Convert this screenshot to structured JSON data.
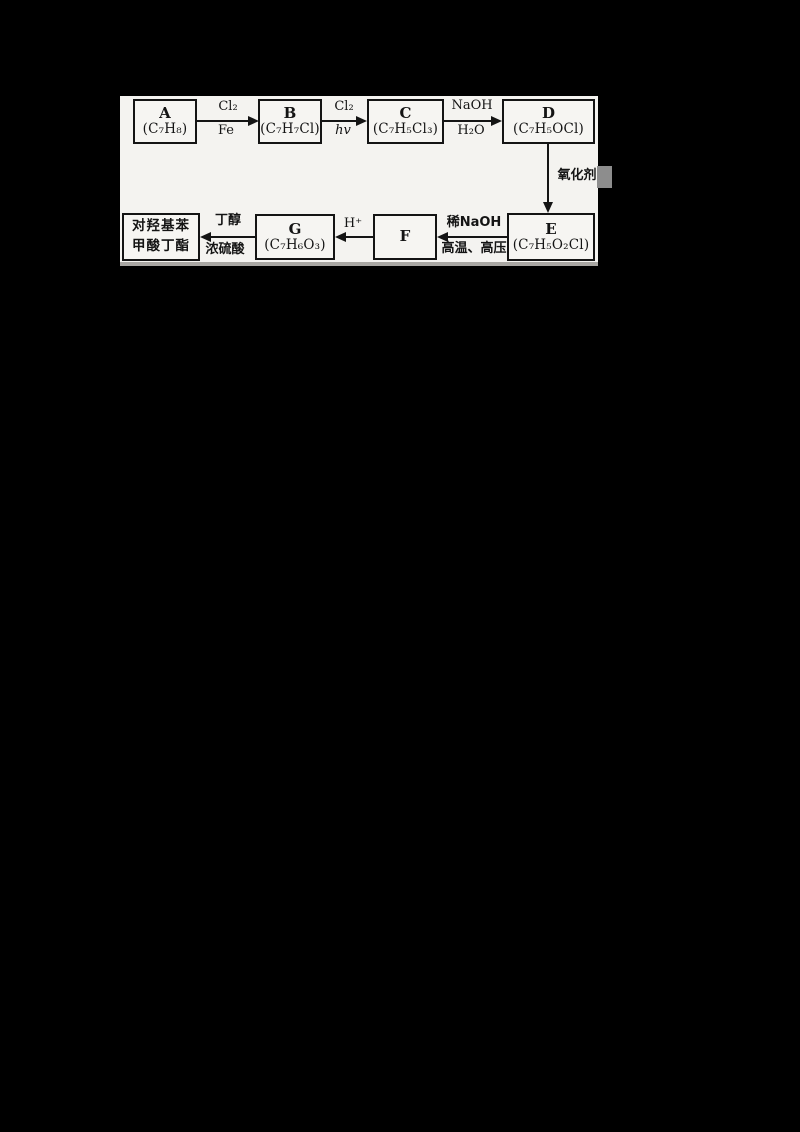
{
  "diagram": {
    "colors": {
      "page_bg": "#000000",
      "panel_bg": "#f4f3f0",
      "ink": "#141414"
    },
    "boxes": {
      "a": {
        "letter": "A",
        "formula": "(C₇H₈)"
      },
      "b": {
        "letter": "B",
        "formula": "(C₇H₇Cl)"
      },
      "c": {
        "letter": "C",
        "formula": "(C₇H₅Cl₃)"
      },
      "d": {
        "letter": "D",
        "formula": "(C₇H₅OCl)"
      },
      "e": {
        "letter": "E",
        "formula": "(C₇H₅O₂Cl)"
      },
      "f": {
        "letter": "F"
      },
      "g": {
        "letter": "G",
        "formula": "(C₇H₆O₃)"
      },
      "product": {
        "line1": "对羟基苯",
        "line2": "甲酸丁酯"
      }
    },
    "arrows": {
      "a_to_b": {
        "above": "Cl₂",
        "below": "Fe"
      },
      "b_to_c": {
        "above": "Cl₂",
        "below": "hv"
      },
      "c_to_d": {
        "above": "NaOH",
        "below": "H₂O"
      },
      "d_to_e": {
        "side": "氧化剂"
      },
      "e_to_f": {
        "above": "稀NaOH",
        "below": "高温、高压"
      },
      "f_to_g": {
        "above": "H⁺"
      },
      "g_to_product": {
        "above": "丁醇",
        "below": "浓硫酸"
      }
    }
  }
}
